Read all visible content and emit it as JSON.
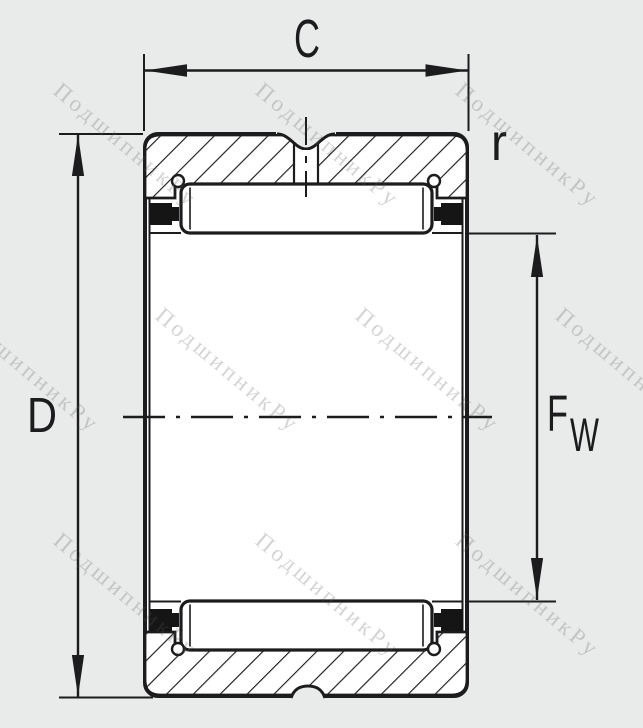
{
  "drawing": {
    "type_note": "needle roller bearing cross-section",
    "dimensions": {
      "width_label": "C",
      "outer_diameter_label": "D",
      "chamfer_radius_label": "r",
      "bore_diameter_label_main": "F",
      "bore_diameter_label_sub": "W"
    }
  },
  "watermark": {
    "text": "ПодшипникРу",
    "angle": 40,
    "positions": [
      {
        "x": 52,
        "y": 93
      },
      {
        "x": 254,
        "y": 93
      },
      {
        "x": 454,
        "y": 93
      },
      {
        "x": -46,
        "y": 318
      },
      {
        "x": 154,
        "y": 318
      },
      {
        "x": 354,
        "y": 318
      },
      {
        "x": 554,
        "y": 318
      },
      {
        "x": 52,
        "y": 543
      },
      {
        "x": 254,
        "y": 543
      },
      {
        "x": 454,
        "y": 543
      }
    ]
  },
  "colors": {
    "background": "#e9eaea",
    "ink": "#1c1c1e",
    "paper": "#ffffff",
    "seal": "#151515",
    "watermark": "rgba(90,90,90,0.26)"
  }
}
